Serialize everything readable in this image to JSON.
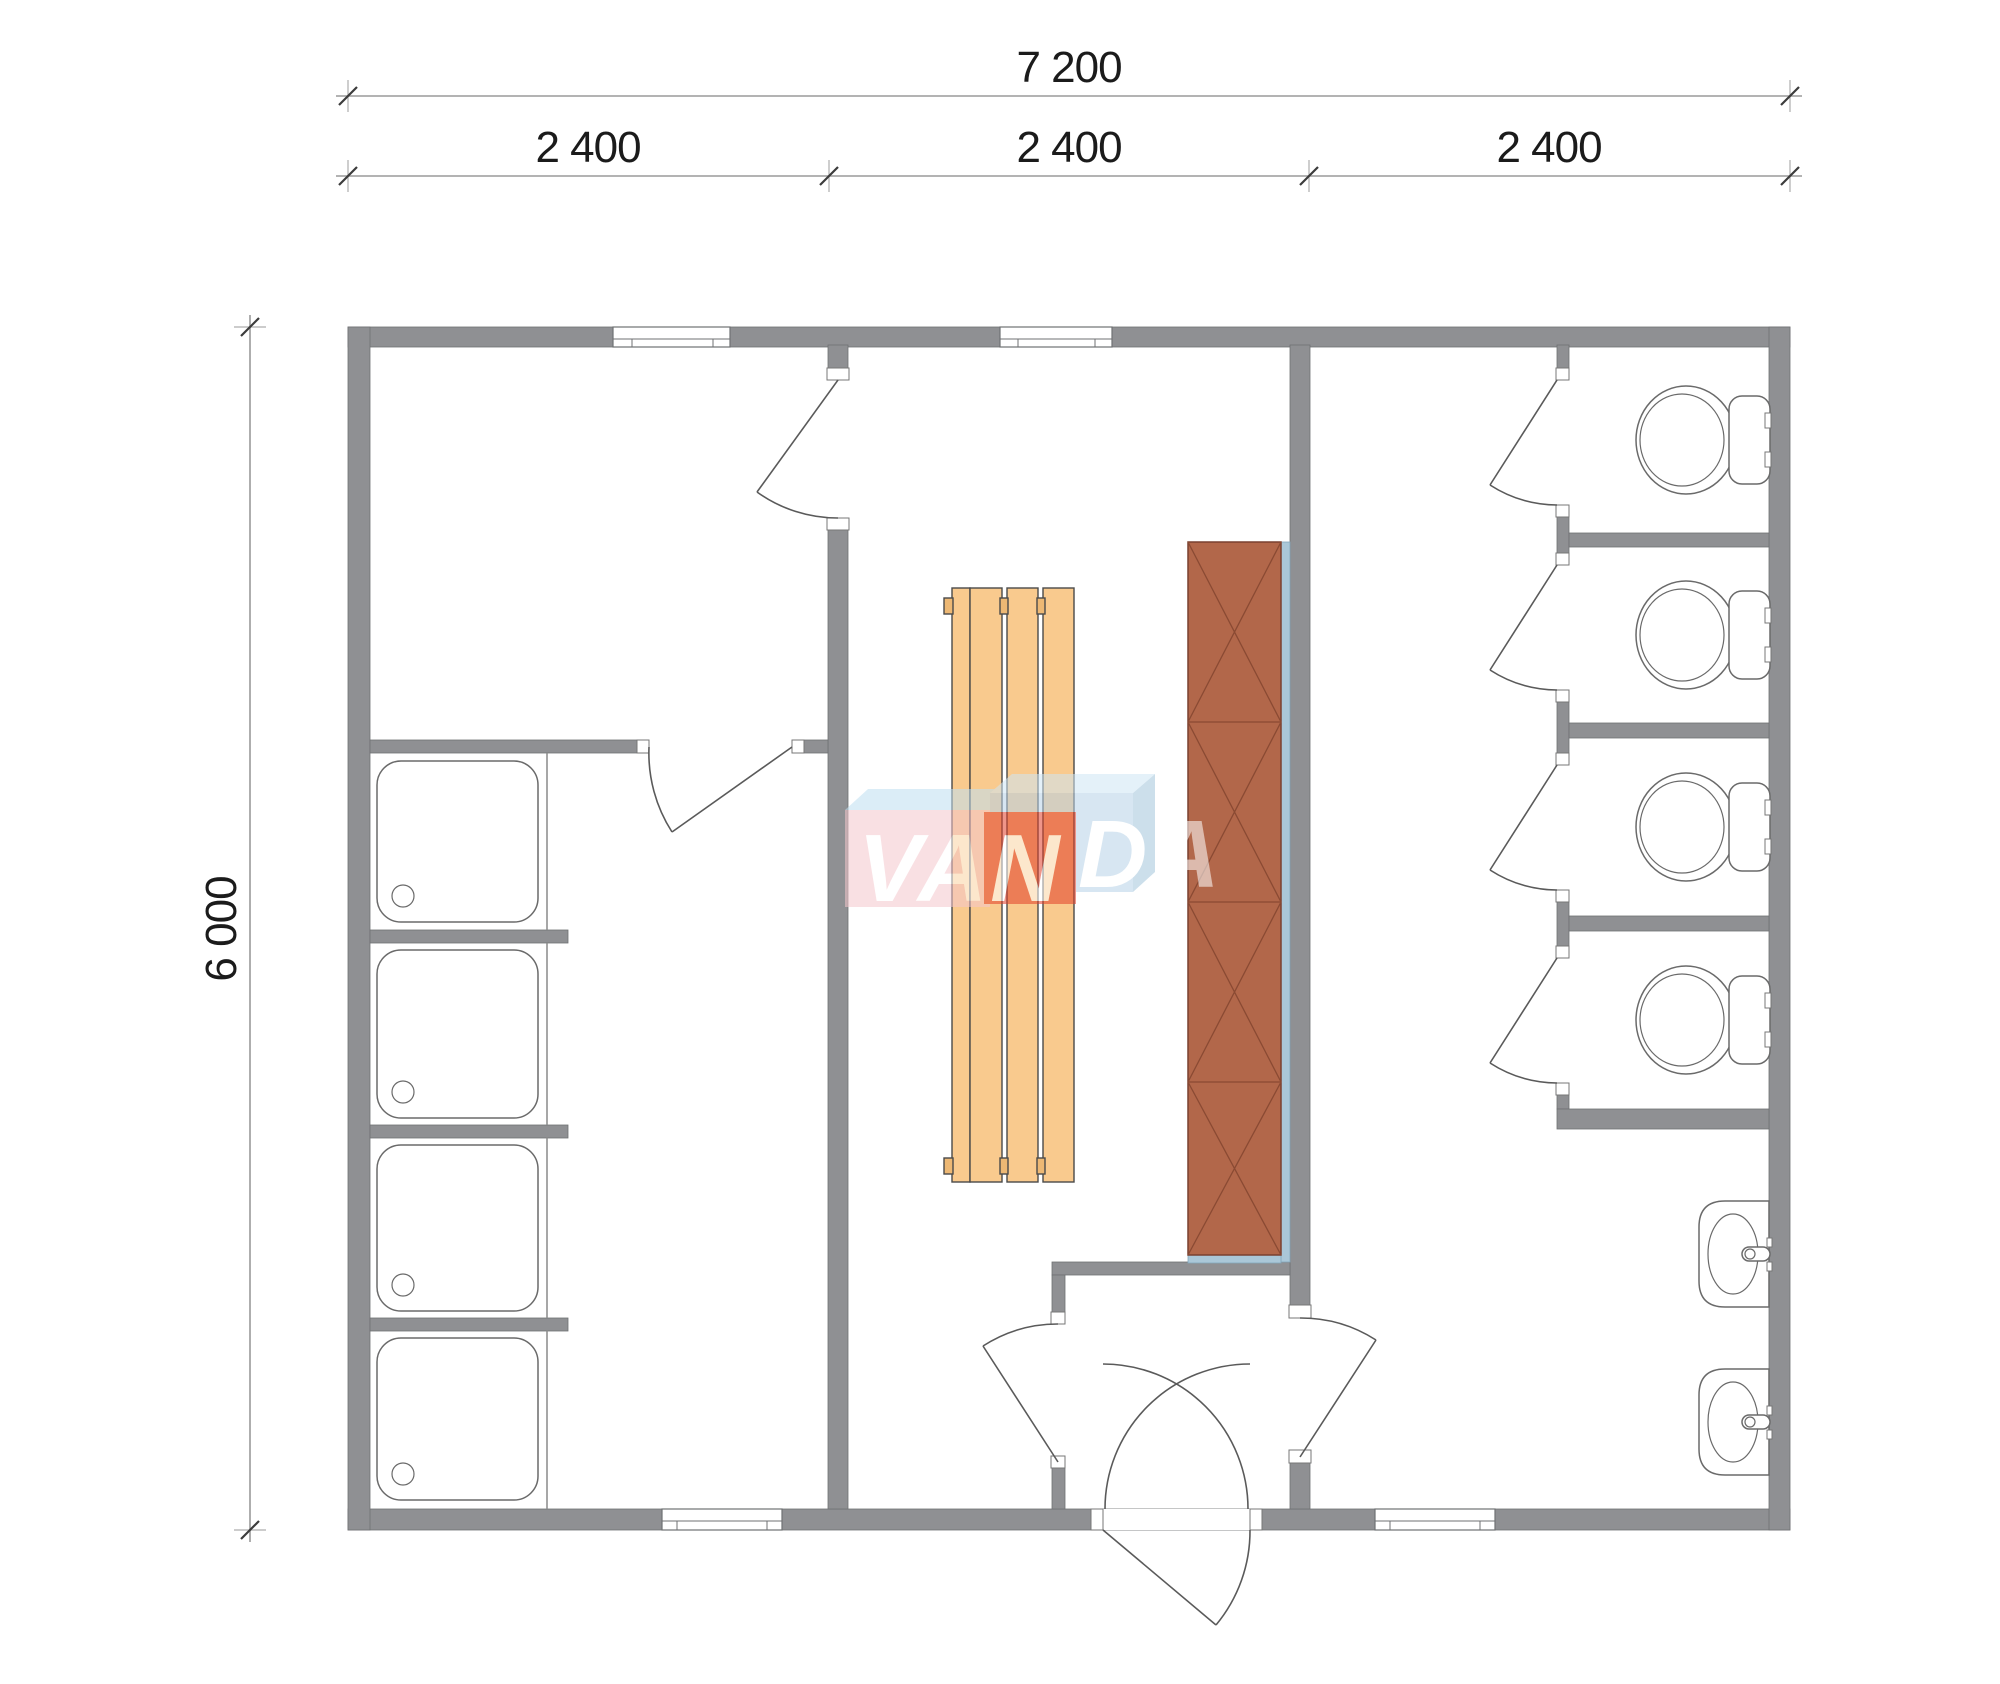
{
  "dimensions": {
    "overall_width": "7 200",
    "bays": [
      "2 400",
      "2 400",
      "2 400"
    ],
    "overall_height": "6 000"
  },
  "logo": {
    "full": "VANDA",
    "left": "VAN",
    "right": "DA"
  },
  "colors": {
    "wall": "#8f9093",
    "bench_wood": "#f9ca8e",
    "bench_tab": "#edb874",
    "heater_panel": "#b2674a",
    "insulation_strip": "#aac7d8",
    "logo_red": "#e2402a",
    "logo_pink": "#f5c7cd",
    "logo_pink_top": "#bfe0f2",
    "logo_blue": "#b7d3e8",
    "logo_blue_top": "#cfe7f5",
    "logo_blue_side": "#a3c5dc",
    "dimension_text": "#1b1b1b"
  },
  "fixtures": {
    "shower_trays": 4,
    "toilets": 4,
    "sinks": 2,
    "bench_boards": 4,
    "heater_sections": 4
  }
}
